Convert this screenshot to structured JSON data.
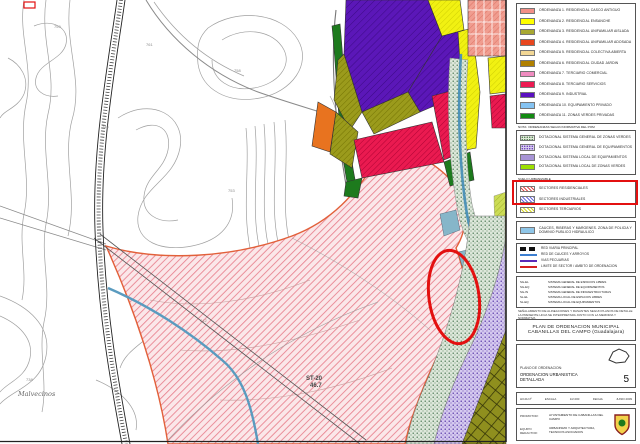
{
  "legend": {
    "ordenanzas": {
      "rows": [
        {
          "color": "#f28f87",
          "label": "ORDENANZA 1. RESIDENCIAL CASCO ANTIGUO"
        },
        {
          "color": "#ffff00",
          "label": "ORDENANZA 2. RESIDENCIAL ENSANCHE"
        },
        {
          "color": "#a8a832",
          "label": "ORDENANZA 3. RESIDENCIAL UNIFAMILIAR AISLADA"
        },
        {
          "color": "#e8471f",
          "label": "ORDENANZA 4. RESIDENCIAL UNIFAMILIAR ADOSADA"
        },
        {
          "color": "#f2d795",
          "label": "ORDENANZA 5. RESIDENCIAL COLECTIVA ABIERTA"
        },
        {
          "color": "#b08000",
          "label": "ORDENANZA 6. RESIDENCIAL CIUDAD JARDIN"
        },
        {
          "color": "#f08cc0",
          "label": "ORDENANZA 7. TERCIARIO COMERCIAL"
        },
        {
          "color": "#ec1a52",
          "label": "ORDENANZA 8. TERCIARIO SERVICIOS"
        },
        {
          "color": "#5a10c0",
          "label": "ORDENANZA 9. INDUSTRIAL"
        },
        {
          "color": "#85c3f2",
          "label": "ORDENANZA 10. EQUIPAMIENTO PRIVADO"
        },
        {
          "color": "#128a12",
          "label": "ORDENANZA 11. ZONAS VERDES PRIVADAS"
        }
      ],
      "footnote": "NOTA: ORDENANZAS SEGUN NORMATIVA DEL POM"
    },
    "dotacional": {
      "rows": [
        {
          "swatch": "dots-green",
          "label": "DOTACIONAL SISTEMA GENERAL DE ZONAS VERDES"
        },
        {
          "swatch": "dots-purple",
          "label": "DOTACIONAL SISTEMA GENERAL DE EQUIPAMIENTOS"
        },
        {
          "swatch": "dots-purple2",
          "label": "DOTACIONAL SISTEMA LOCAL DE EQUIPAMIENTOS"
        },
        {
          "swatch": "solid-green",
          "label": "DOTACIONAL SISTEMA LOCAL DE ZONAS VERDES"
        }
      ]
    },
    "heading_urbanizable": "SUELO URBANIZABLE",
    "urbanizable": {
      "rows": [
        {
          "swatch": "hatch-red",
          "label": "SECTORES RESIDENCIALES"
        },
        {
          "swatch": "hatch-blue",
          "label": "SECTORES INDUSTRIALES"
        },
        {
          "swatch": "hatch-yellow",
          "label": "SECTORES TERCIARIOS"
        }
      ]
    },
    "agua_label": "CAUCES, RIBERAS Y MARGENES. ZONA DE POLICIA Y DOMINIO PUBLICO HIDRAULICO",
    "lineas": {
      "rows": [
        {
          "sym": "sym-road",
          "label": "RED VIARIA PRINCIPAL"
        },
        {
          "sym": "sym-blue",
          "label": "RED DE CAUCES Y ARROYOS"
        },
        {
          "sym": "sym-purple",
          "label": "VIAS PECUARIAS"
        },
        {
          "sym": "sym-red",
          "label": "LIMITE DE SECTOR / AMBITO DE ORDENACION"
        }
      ]
    },
    "abreviaturas": {
      "rows": [
        {
          "abbr": "SG-EL",
          "label": "SISTEMA GENERAL DE ESPACIOS LIBRES"
        },
        {
          "abbr": "SG-EQ",
          "label": "SISTEMA GENERAL DE EQUIPAMIENTOS"
        },
        {
          "abbr": "SG-IN",
          "label": "SISTEMA GENERAL DE INFRAESTRUCTURAS"
        },
        {
          "abbr": "SL-EL",
          "label": "SISTEMA LOCAL DE ESPACIOS LIBRES"
        },
        {
          "abbr": "SL-EQ",
          "label": "SISTEMA LOCAL DE EQUIPAMIENTOS"
        }
      ]
    },
    "notas": {
      "n1": "SEÑALAMIENTO DE ALINEACIONES Y RASANTES SEGUN PLANOS DE DETALLE",
      "n2": "LA PRESENTE HOJA SE INTERPRETARA JUNTO CON LA MEMORIA Y NORMATIVA"
    },
    "title_line1": "PLAN DE ORDENACION MUNICIPAL",
    "title_line2": "CABANILLAS DEL CAMPO (Guadalajara)",
    "plano": {
      "label": "PLANO DE ORDENACION:",
      "name": "ORDENACION URBANISTICA DETALLADA",
      "number": "5"
    },
    "fields": {
      "f1": "HOJA Nº",
      "f2": "ESCALA",
      "f3": "1/2.000",
      "f4": "FECHA",
      "f5": "JUNIO 2009"
    },
    "promotor_label": "PROMOTOR:",
    "promotor": "AYUNTAMIENTO DE CABANILLAS DEL CAMPO",
    "redactor_label": "EQUIPO REDACTOR:",
    "redactor": "URBANISMO Y ARQUITECTURA, TECNICOS ASOCIADOS"
  },
  "map": {
    "labels": {
      "sector_code": "ST-20",
      "sector_area": "46.7",
      "place_name": "Malvecinos",
      "e1": "759",
      "e2": "761",
      "e3": "758",
      "e4": "746",
      "e5": "753",
      "e6": "738",
      "e7": "742"
    },
    "annotation_color": "#e31010"
  }
}
